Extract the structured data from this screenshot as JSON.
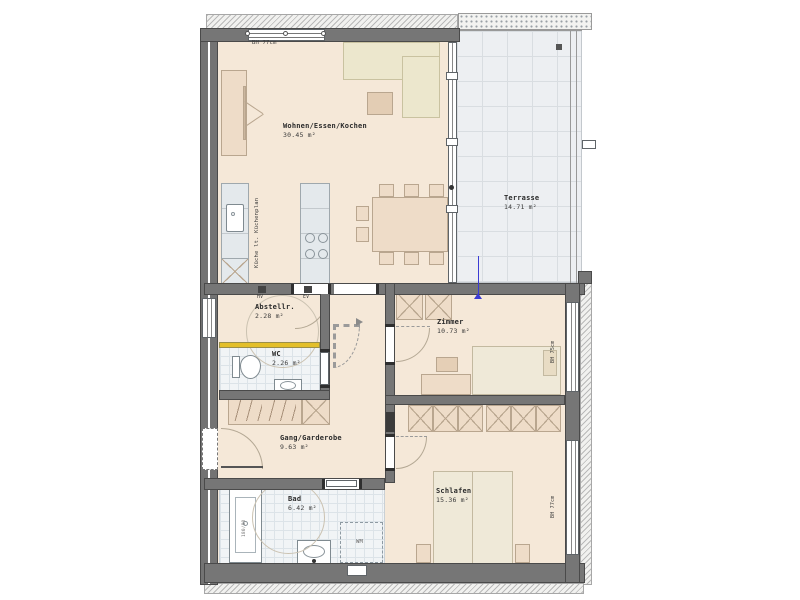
{
  "plan": {
    "rooms": {
      "wohnen": {
        "name": "Wohnen/Essen/Kochen",
        "area": "30.45 m²"
      },
      "terrasse": {
        "name": "Terrasse",
        "area": "14.71 m²"
      },
      "abstellraum": {
        "name": "Abstellr.",
        "area": "2.28 m²"
      },
      "wc": {
        "name": "WC",
        "area": "2.26 m²"
      },
      "zimmer": {
        "name": "Zimmer",
        "area": "10.73 m²"
      },
      "gang": {
        "name": "Gang/Garderobe",
        "area": "9.63 m²"
      },
      "bad": {
        "name": "Bad",
        "area": "6.42 m²"
      },
      "schlafen": {
        "name": "Schlafen",
        "area": "15.36 m²"
      }
    },
    "annotations": {
      "sill_height_top": "BH 77cm",
      "sill_height_zimmer": "BH 75cm",
      "sill_height_schlafen": "BH 77cm",
      "kitchen_note": "Küche lt. Küchenplan",
      "hv": "HV",
      "ev": "EV",
      "washing_machine": "WM",
      "bathtub_size": "180/80"
    },
    "colors": {
      "wall": "#767676",
      "floor": "#f5e8d8",
      "tile": "#f1f4f6",
      "terrace": "#edeff2",
      "furniture": "#eedcc8",
      "sofa": "#ece7cd",
      "accent_yellow": "#e3bf2a",
      "marker_blue": "#3b3bd4"
    }
  }
}
